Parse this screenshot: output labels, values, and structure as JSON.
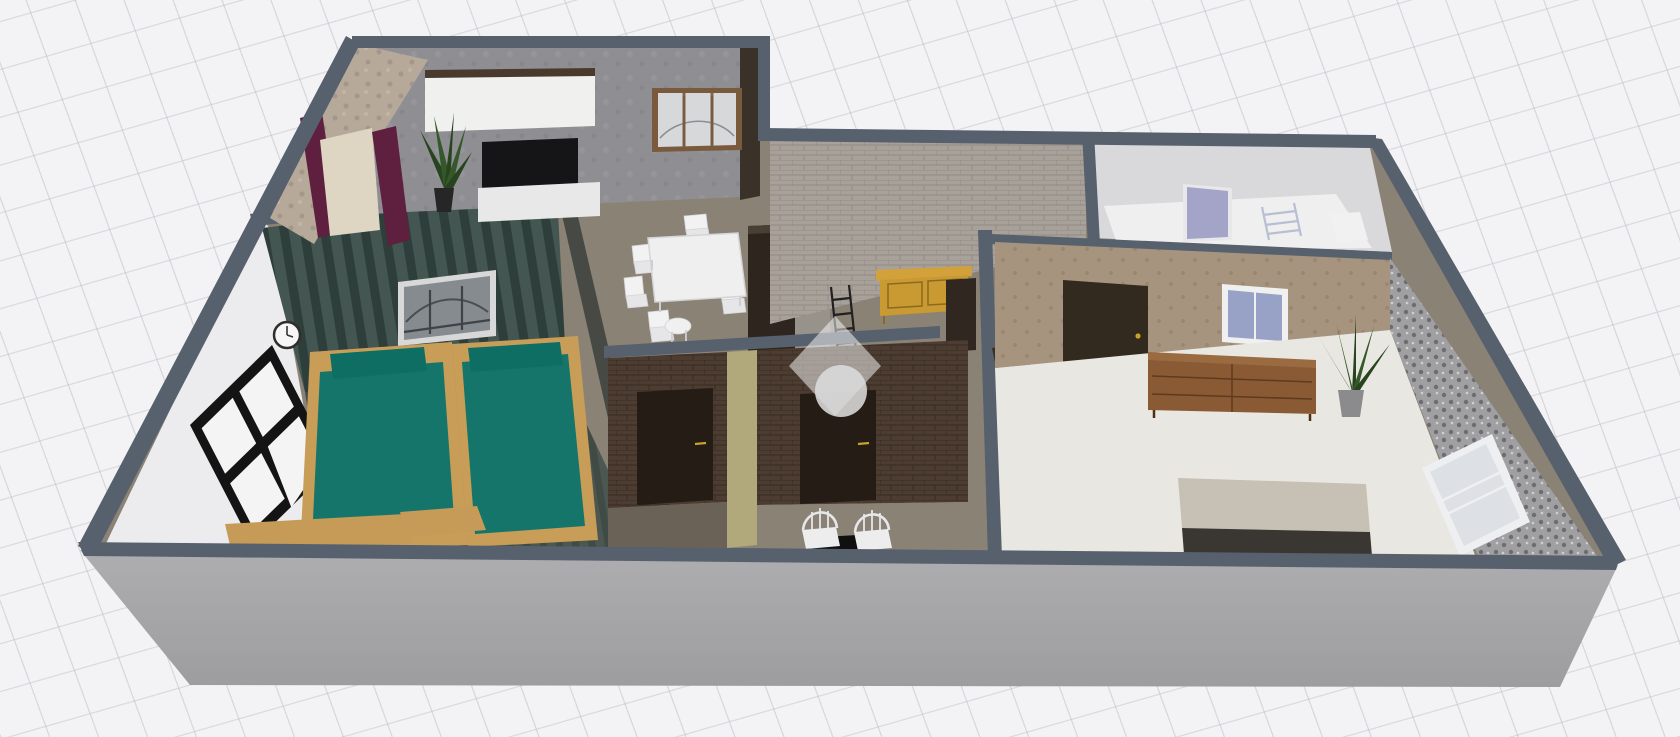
{
  "scene": {
    "type": "3d-floor-plan-render",
    "description": "Isometric 3D render of an apartment interior viewed from the front-left on a light perspective grid background, watermarked with a translucent diamond-and-circle logo",
    "watermark": {
      "icon": "diamond-circle-logo",
      "style": "translucent white diamond with light gray circle"
    },
    "rooms": [
      {
        "name": "living-room",
        "walls": "gray concrete and beige stone",
        "floor": "gray-brown",
        "furniture": [
          "wall-cabinet",
          "tall-cabinet",
          "tv",
          "media-console",
          "potted-plant",
          "curtains",
          "bridge-view-window"
        ]
      },
      {
        "name": "twin-bedroom",
        "walls": "white and dark teal striped accent",
        "floor": "dark teal planks",
        "furniture": [
          "twin-bed",
          "twin-bed",
          "foot-bench",
          "foot-bench",
          "wall-clock",
          "bridge-picture",
          "black-frame-window"
        ]
      },
      {
        "name": "dining-area",
        "walls": "gray concrete",
        "floor": "gray-brown",
        "furniture": [
          "dining-table",
          "chair",
          "chair",
          "chair",
          "chair",
          "chair",
          "chair",
          "stool"
        ]
      },
      {
        "name": "hallway",
        "walls": "whitewashed brick",
        "floor": "gray-brown",
        "furniture": [
          "wardrobe",
          "gray-column",
          "console-table",
          "decor-ladder",
          "dark-cabinet",
          "small-plant"
        ]
      },
      {
        "name": "bathroom-left",
        "walls": "dark brick",
        "furniture": [
          "dark-door"
        ]
      },
      {
        "name": "bathroom-right",
        "walls": "dark brick",
        "furniture": [
          "dark-door",
          "vanity-desk",
          "spindle-chair",
          "spindle-chair"
        ]
      },
      {
        "name": "top-right-bathroom",
        "walls": "white",
        "floor": "white",
        "furniture": [
          "lilac-door",
          "towel-ladder",
          "shelf-block"
        ]
      },
      {
        "name": "master-bedroom",
        "walls": "tan and gray damask wallpaper",
        "floor": "off-white",
        "furniture": [
          "dark-door",
          "blue-window",
          "dresser",
          "potted-plant",
          "double-bed",
          "white-window"
        ]
      }
    ],
    "palette": {
      "wallPlate": "#57606d",
      "edgeWall": "#474a44",
      "exteriorFace": "#a7a7a9",
      "baseFloor": "#8b8276",
      "darkFloor": "#6b6257",
      "masterFloor": "#e9e7e2",
      "bathFloor": "#efeff0",
      "whiteWall": "#ececee",
      "bathWall": "#d9d9dc",
      "concreteWall": "#8f8f93",
      "stoneWall": "#b6a99a",
      "brickLight": "#a7a19a",
      "brickLightMortar": "#918a82",
      "brickDark": "#4c3c31",
      "brickDarkMortar": "#382b21",
      "stripeBase": "#445651",
      "stripeDark": "#2e3e3a",
      "plankBase": "#4d5751",
      "plankDark": "#414b46",
      "tanWall": "#a6947f",
      "damaskBase": "#a0a0a2",
      "oliveWall": "#b1a87c",
      "doorDark": "#251c15",
      "doorBrown": "#32291f",
      "lilacDoor": "#a3a4c8",
      "handleGold": "#c9a227",
      "tealBed": "#15756a",
      "tealPillow": "#0e6e64",
      "woodBed": "#c89d58",
      "woodBench": "#c59b57",
      "woodConsole": "#d3a139",
      "woodDresser": "#8a5a35",
      "woodFrame": "#7a5a3c",
      "tvBlack": "#151517",
      "consoleWhite": "#e8e8e8",
      "cabinetWhite": "#f0f0ef",
      "cabinetTop": "#4a3a2e",
      "wardrobeDark": "#2d251e",
      "columnGray": "#97928a",
      "glassBlue": "#98a2c6",
      "glassLight": "#d6d8da",
      "curtainMaroon": "#5f1f3f",
      "curtainSheer": "#ded5c2",
      "plantDark": "#27431f",
      "plantLight": "#35582a",
      "potGray": "#8b8b8d",
      "sofaNA": "#6f6b66",
      "clockFace": "#f6f6f6",
      "ladderBlack": "#202020",
      "towelLadder": "#b8bfd2",
      "watermarkDiamond": "rgba(255,255,255,0.5)",
      "watermarkCircle": "#dcdcdc"
    }
  }
}
